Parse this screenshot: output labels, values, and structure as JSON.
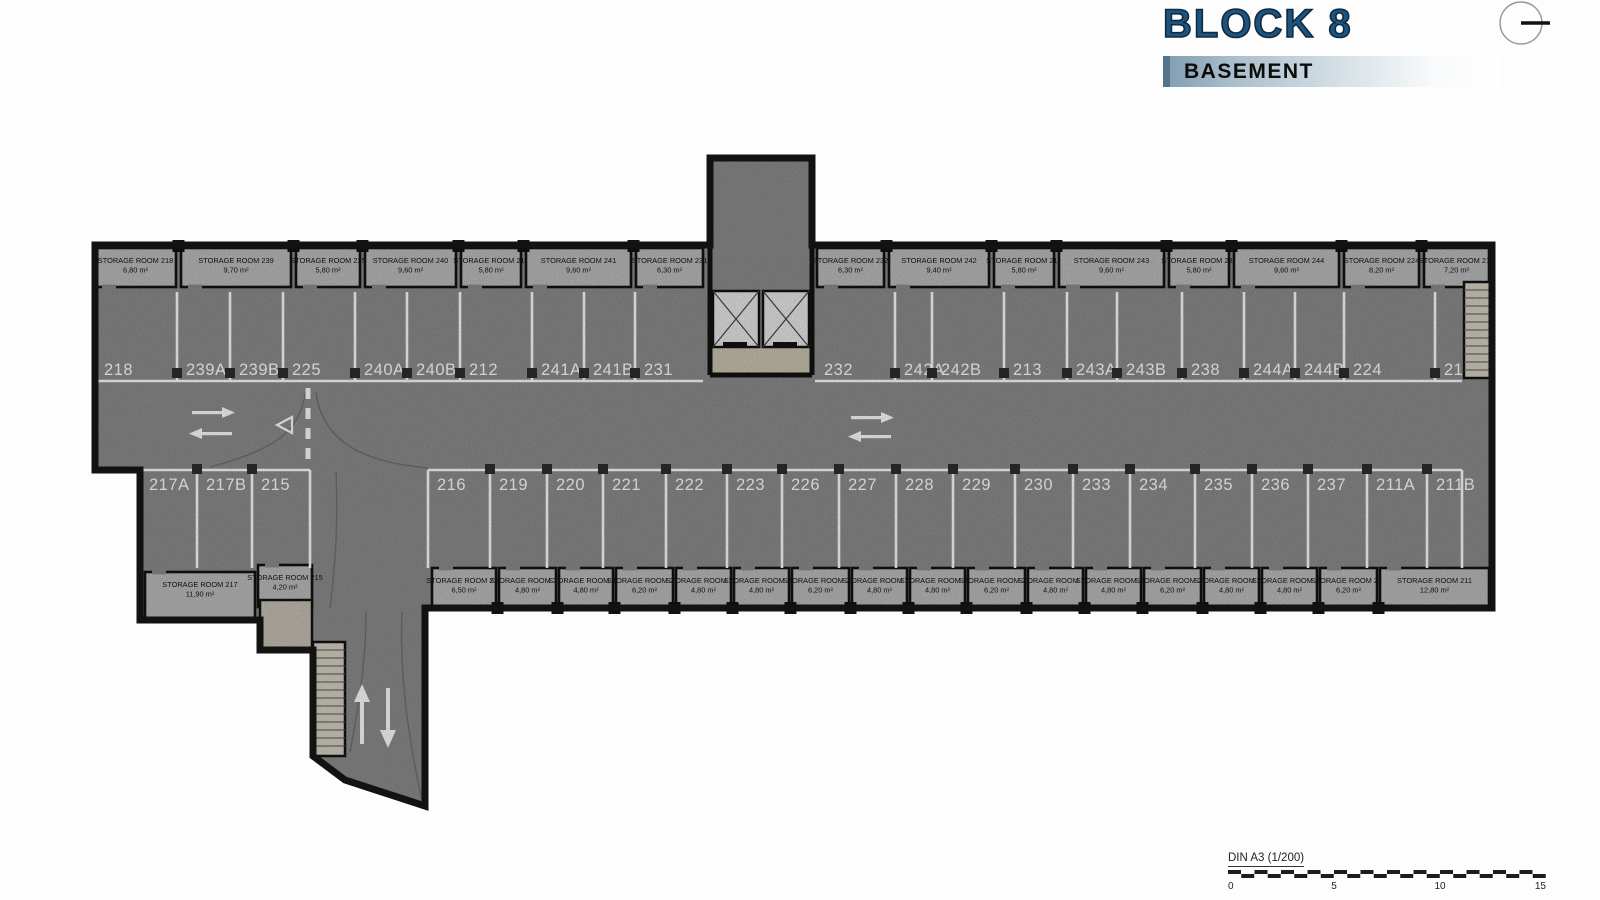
{
  "header": {
    "block_title": "BLOCK 8",
    "floor_label": "BASEMENT"
  },
  "plan": {
    "top_storage": [
      {
        "label": "STORAGE ROOM 218",
        "area": "6,80 m²"
      },
      {
        "label": "STORAGE ROOM 239",
        "area": "9,70 m²"
      },
      {
        "label": "STORAGE ROOM 225",
        "area": "5,80 m²"
      },
      {
        "label": "STORAGE ROOM 240",
        "area": "9,60 m²"
      },
      {
        "label": "STORAGE ROOM 212",
        "area": "5,80 m²"
      },
      {
        "label": "STORAGE ROOM 241",
        "area": "9,60 m²"
      },
      {
        "label": "STORAGE ROOM 231",
        "area": "6,30 m²"
      },
      {
        "label": "STORAGE ROOM 232",
        "area": "6,30 m²"
      },
      {
        "label": "STORAGE ROOM 242",
        "area": "9,40 m²"
      },
      {
        "label": "STORAGE ROOM 213",
        "area": "5,80 m²"
      },
      {
        "label": "STORAGE ROOM 243",
        "area": "9,60 m²"
      },
      {
        "label": "STORAGE ROOM 238",
        "area": "5,80 m²"
      },
      {
        "label": "STORAGE ROOM 244",
        "area": "9,60 m²"
      },
      {
        "label": "STORAGE ROOM 224",
        "area": "8,20 m²"
      },
      {
        "label": "STORAGE ROOM 214",
        "area": "7,20 m²"
      }
    ],
    "bottom_storage": [
      {
        "label": "STORAGE ROOM 216",
        "area": "6,50 m²"
      },
      {
        "label": "STORAGE ROOM 219",
        "area": "4,80 m²"
      },
      {
        "label": "STORAGE ROOM 220",
        "area": "4,80 m²"
      },
      {
        "label": "STORAGE ROOM 221",
        "area": "6,20 m²"
      },
      {
        "label": "STORAGE ROOM 222",
        "area": "4,80 m²"
      },
      {
        "label": "STORAGE ROOM 223",
        "area": "4,80 m²"
      },
      {
        "label": "STORAGE ROOM 226",
        "area": "6,20 m²"
      },
      {
        "label": "STORAGE ROOM 227",
        "area": "4,80 m²"
      },
      {
        "label": "STORAGE ROOM 228",
        "area": "4,80 m²"
      },
      {
        "label": "STORAGE ROOM 229",
        "area": "6,20 m²"
      },
      {
        "label": "STORAGE ROOM 230",
        "area": "4,80 m²"
      },
      {
        "label": "STORAGE ROOM 233",
        "area": "4,80 m²"
      },
      {
        "label": "STORAGE ROOM 234",
        "area": "6,20 m²"
      },
      {
        "label": "STORAGE ROOM 235",
        "area": "4,80 m²"
      },
      {
        "label": "STORAGE ROOM 236",
        "area": "4,80 m²"
      },
      {
        "label": "STORAGE ROOM 237",
        "area": "6,20 m²"
      },
      {
        "label": "STORAGE ROOM 211",
        "area": "12,80 m²"
      }
    ],
    "left_storage": [
      {
        "label": "STORAGE ROOM 217",
        "area": "11,90 m²"
      },
      {
        "label": "STORAGE ROOM 215",
        "area": "4,20 m²"
      }
    ],
    "top_left_spots": [
      "218",
      "239A",
      "239B",
      "225",
      "240A",
      "240B",
      "212",
      "241A",
      "241B",
      "231"
    ],
    "top_right_spots": [
      "232",
      "242A",
      "242B",
      "213",
      "243A",
      "243B",
      "238",
      "244A",
      "244B",
      "224",
      "214"
    ],
    "bottom_left_spots": [
      "217A",
      "217B",
      "215"
    ],
    "bottom_main_spots": [
      "216",
      "219",
      "220",
      "221",
      "222",
      "223",
      "226",
      "227",
      "228",
      "229",
      "230",
      "233",
      "234",
      "235",
      "236",
      "237",
      "211A",
      "211B"
    ]
  },
  "scale": {
    "label": "DIN A3 (1/200)",
    "ticks": [
      "0",
      "5",
      "10",
      "15"
    ]
  },
  "colors": {
    "floor": "#8d8d8d",
    "storage": "#bdbdbd",
    "wall": "#121212",
    "stair": "#d8d2c4",
    "lobby": "#cdc5b2",
    "accent_blue": "#1e537d"
  }
}
